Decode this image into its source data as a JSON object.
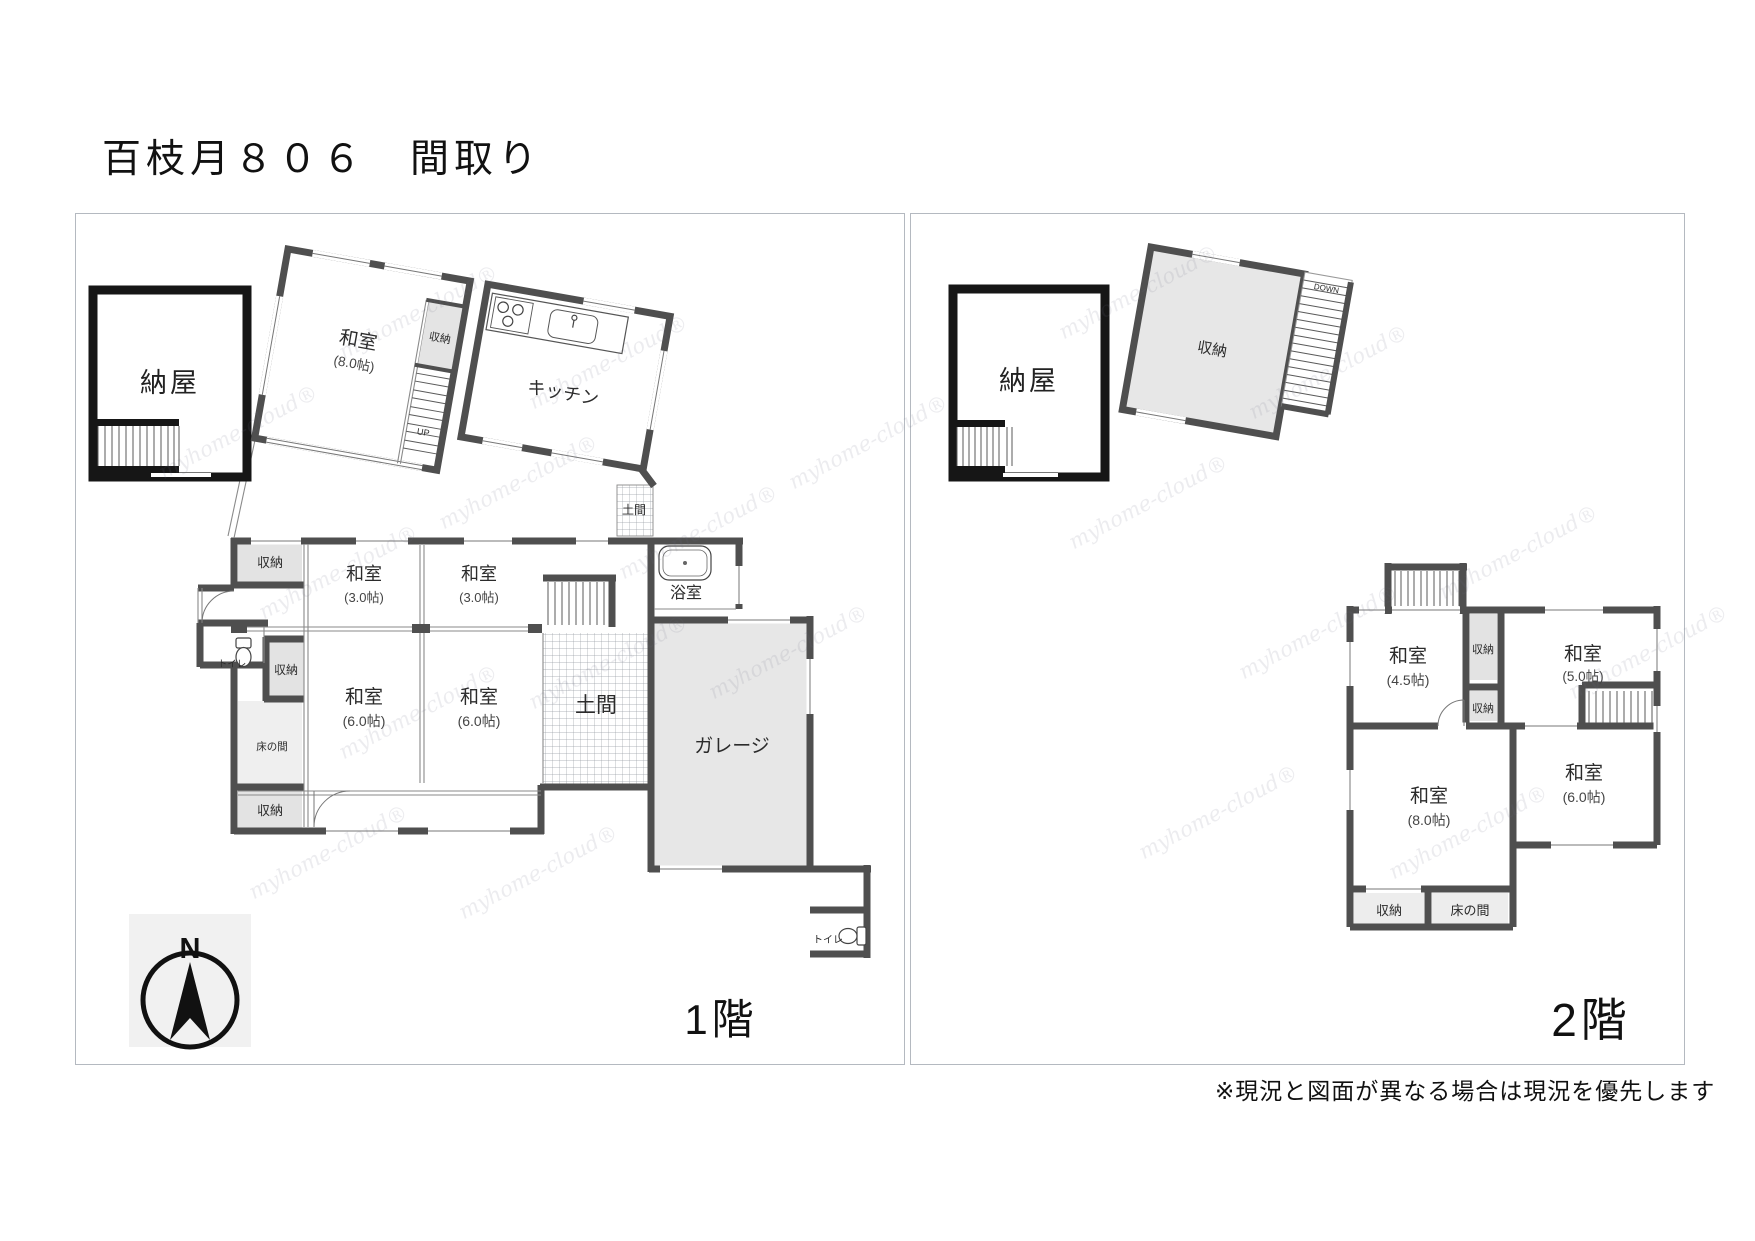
{
  "title": "百枝月８０６　間取り",
  "note": "※現況と図面が異なる場合は現況を優先します",
  "watermark": "myhome-cloud®",
  "compass": "N",
  "floor1": {
    "label": "1階",
    "naya": "納屋",
    "washitsu8_name": "和室",
    "washitsu8_size": "(8.0帖)",
    "shuno8": "収納",
    "up": "UP",
    "kitchen": "キッチン",
    "doma_small": "土間",
    "shuno_mid": "収納",
    "washitsu3a_name": "和室",
    "washitsu3a_size": "(3.0帖)",
    "washitsu3b_name": "和室",
    "washitsu3b_size": "(3.0帖)",
    "bath": "浴室",
    "toilet_left": "トイレ",
    "shuno_toilet": "収納",
    "tokonoma": "床の間",
    "shuno_bottom": "収納",
    "washitsu6a_name": "和室",
    "washitsu6a_size": "(6.0帖)",
    "washitsu6b_name": "和室",
    "washitsu6b_size": "(6.0帖)",
    "doma_big": "土間",
    "garage": "ガレージ",
    "toilet_right": "トイレ"
  },
  "floor2": {
    "label": "2階",
    "naya": "納屋",
    "shuno_big": "収納",
    "down": "DOWN",
    "washitsu45_name": "和室",
    "washitsu45_size": "(4.5帖)",
    "shuno_a": "収納",
    "shuno_b": "収納",
    "washitsu50_name": "和室",
    "washitsu50_size": "(5.0帖)",
    "washitsu80_name": "和室",
    "washitsu80_size": "(8.0帖)",
    "washitsu60_name": "和室",
    "washitsu60_size": "(6.0帖)",
    "shuno_c": "収納",
    "tokonoma": "床の間"
  }
}
